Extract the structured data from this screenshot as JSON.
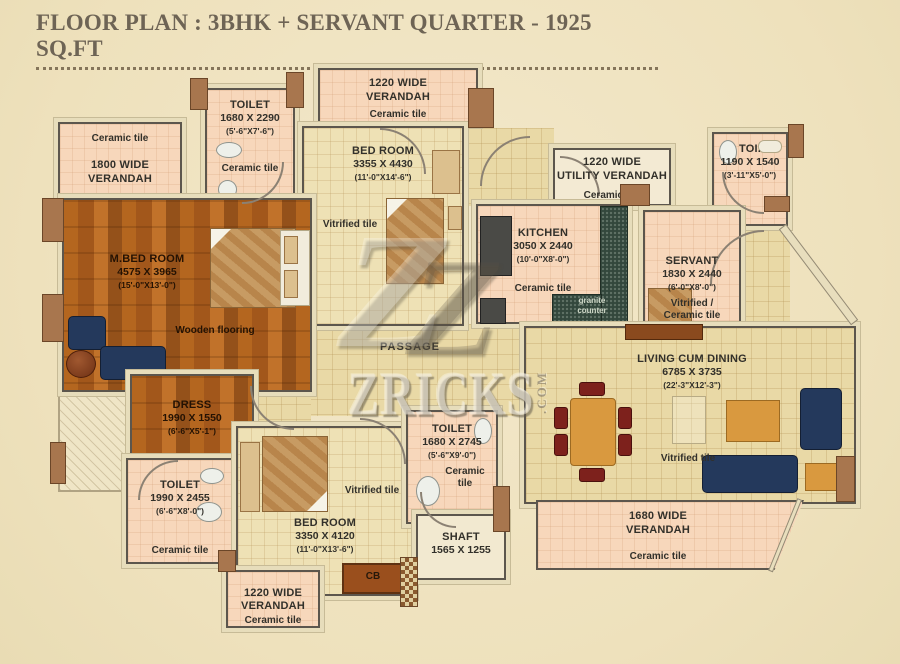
{
  "title": "FLOOR PLAN : 3BHK + SERVANT QUARTER - 1925 SQ.FT",
  "watermark": {
    "logo_letter": "Z",
    "brand": "ZRICKS",
    "suffix": ".COM"
  },
  "rooms": {
    "verandah_top_left": {
      "floor": "Ceramic tile",
      "name1": "1800 WIDE",
      "name2": "VERANDAH"
    },
    "toilet_top": {
      "name": "TOILET",
      "mm": "1680 X 2290",
      "ft": "(5'-6\"X7'-6\")",
      "floor": "Ceramic tile"
    },
    "verandah_top": {
      "name1": "1220 WIDE",
      "name2": "VERANDAH",
      "floor": "Ceramic tile"
    },
    "bedroom_top": {
      "name": "BED ROOM",
      "mm": "3355 X 4430",
      "ft": "(11'-0\"X14'-6\")",
      "floor": "Vitrified tile"
    },
    "utility_verandah": {
      "name1": "1220 WIDE",
      "name2": "UTILITY VERANDAH",
      "floor": "Ceramic tile"
    },
    "toi_right": {
      "name": "TOI.",
      "mm": "1190 X 1540",
      "ft": "(3'-11\"X5'-0\")"
    },
    "kitchen": {
      "name": "KITCHEN",
      "mm": "3050 X 2440",
      "ft": "(10'-0\"X8'-0\")",
      "floor": "Ceramic tile",
      "counter1": "granite",
      "counter2": "counter"
    },
    "servant": {
      "name": "SERVANT",
      "mm": "1830 X 2440",
      "ft": "(6'-0\"X8'-0\")",
      "floor1": "Vitrified /",
      "floor2": "Ceramic tile"
    },
    "m_bedroom": {
      "name": "M.BED ROOM",
      "mm": "4575 X 3965",
      "ft": "(15'-0\"X13'-0\")",
      "floor": "Wooden flooring"
    },
    "dress": {
      "name": "DRESS",
      "mm": "1990 X 1550",
      "ft": "(6'-6\"X5'-1\")"
    },
    "toilet_mbed": {
      "name": "TOILET",
      "mm": "1990 X 2455",
      "ft": "(6'-6\"X8'-0\")",
      "floor": "Ceramic tile"
    },
    "bedroom_bottom": {
      "name": "BED ROOM",
      "mm": "3350 X 4120",
      "ft": "(11'-0\"X13'-6\")",
      "floor": "Vitrified tile"
    },
    "toilet_bottom": {
      "name": "TOILET",
      "mm": "1680 X 2745",
      "ft": "(5'-6\"X9'-0\")",
      "floor1": "Ceramic",
      "floor2": "tile"
    },
    "shaft": {
      "name": "SHAFT",
      "mm": "1565 X 1255"
    },
    "passage": {
      "name": "PASSAGE"
    },
    "living": {
      "name": "LIVING CUM DINING",
      "mm": "6785 X 3735",
      "ft": "(22'-3\"X12'-3\")",
      "floor": "Vitrified tile"
    },
    "verandah_bottom_right": {
      "name1": "1680 WIDE",
      "name2": "VERANDAH",
      "floor": "Ceramic tile"
    },
    "verandah_bottom_left": {
      "name1": "1220 WIDE",
      "name2": "VERANDAH",
      "floor": "Ceramic tile"
    },
    "cb": {
      "label": "CB"
    }
  },
  "colors": {
    "canvas": "#f0e4c4",
    "verandah_pink": "#f7d7bb",
    "room_cream": "#eee1b5",
    "passage_tan": "#e9d9a6",
    "wood": "#b4661f",
    "granite_green": "#33473c",
    "sofa_navy": "#24395c",
    "table_orange": "#d9993f",
    "chair_maroon": "#7d211c",
    "wall_brown": "#a8764e",
    "title_text": "#6e6455"
  }
}
